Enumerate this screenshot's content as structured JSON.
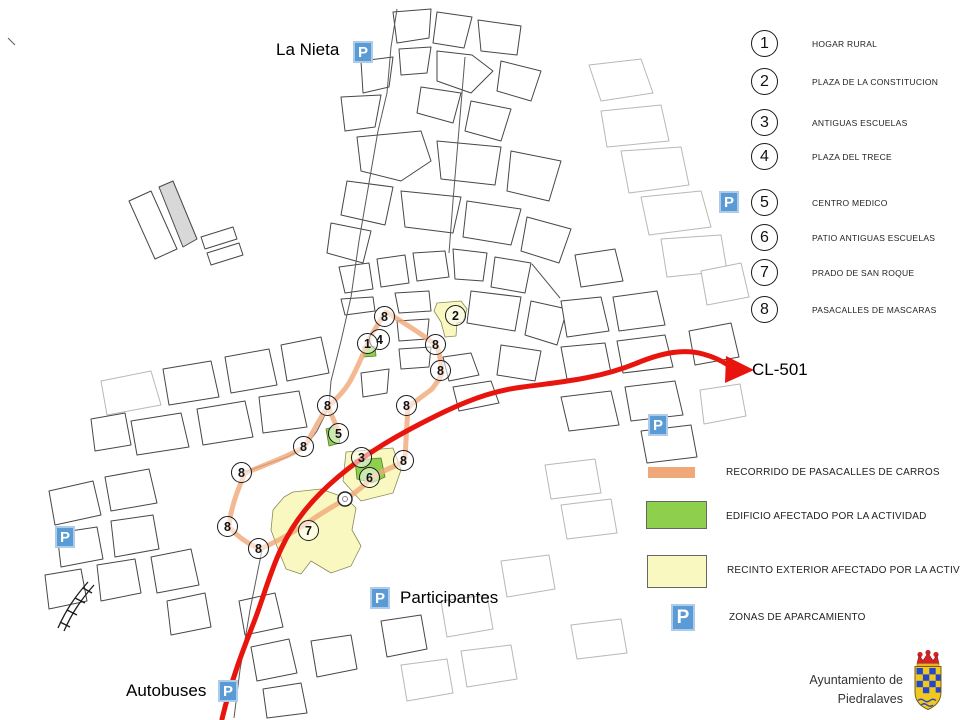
{
  "map_labels": {
    "la_nieta": "La Nieta",
    "cl_501": "CL-501",
    "participantes": "Participantes",
    "autobuses": "Autobuses"
  },
  "parking_symbol": "P",
  "numbered_legend": {
    "items": [
      {
        "number": "1",
        "label": "HOGAR RURAL"
      },
      {
        "number": "2",
        "label": "PLAZA DE LA CONSTITUCION"
      },
      {
        "number": "3",
        "label": "ANTIGUAS ESCUELAS"
      },
      {
        "number": "4",
        "label": "PLAZA DEL TRECE"
      },
      {
        "number": "5",
        "label": "CENTRO MEDICO"
      },
      {
        "number": "6",
        "label": "PATIO ANTIGUAS ESCUELAS"
      },
      {
        "number": "7",
        "label": "PRADO DE SAN ROQUE"
      },
      {
        "number": "8",
        "label": "PASACALLES DE MASCARAS"
      }
    ]
  },
  "zone_legend": {
    "items": [
      {
        "type": "route",
        "color": "#f2a46c",
        "label": "RECORRIDO DE PASACALLES DE CARROS"
      },
      {
        "type": "building",
        "color": "#8ed04e",
        "label": "EDIFICIO AFECTADO POR LA ACTIVIDAD"
      },
      {
        "type": "area",
        "color": "#fafac0",
        "label": "RECINTO EXTERIOR AFECTADO POR LA ACTIVIDAD"
      },
      {
        "type": "parking",
        "color": "#5b9bd5",
        "label": "ZONAS DE APARCAMIENTO"
      }
    ]
  },
  "colors": {
    "road": "#e8150e",
    "route": "#f0a878",
    "building": "#8ed04e",
    "area": "#f8f8c0",
    "parking_blue": "#5b9bd5"
  },
  "map_markers": [
    {
      "n": "8",
      "x": 385,
      "y": 317
    },
    {
      "n": "2",
      "x": 456,
      "y": 316
    },
    {
      "n": "4",
      "x": 380,
      "y": 340
    },
    {
      "n": "1",
      "x": 368,
      "y": 344
    },
    {
      "n": "8",
      "x": 436,
      "y": 345
    },
    {
      "n": "8",
      "x": 441,
      "y": 371
    },
    {
      "n": "8",
      "x": 328,
      "y": 406
    },
    {
      "n": "8",
      "x": 407,
      "y": 406
    },
    {
      "n": "5",
      "x": 339,
      "y": 434
    },
    {
      "n": "8",
      "x": 304,
      "y": 447
    },
    {
      "n": "3",
      "x": 362,
      "y": 458
    },
    {
      "n": "8",
      "x": 404,
      "y": 461
    },
    {
      "n": "6",
      "x": 370,
      "y": 478
    },
    {
      "n": "8",
      "x": 242,
      "y": 473
    },
    {
      "n": "8",
      "x": 228,
      "y": 527
    },
    {
      "n": "7",
      "x": 309,
      "y": 531
    },
    {
      "n": "8",
      "x": 259,
      "y": 549
    }
  ],
  "parking_markers": [
    {
      "x": 363,
      "y": 52
    },
    {
      "x": 658,
      "y": 425
    },
    {
      "x": 65,
      "y": 537
    },
    {
      "x": 380,
      "y": 598
    },
    {
      "x": 228,
      "y": 691
    }
  ],
  "footer": {
    "line1": "Ayuntamiento de",
    "line2": "Piedralaves"
  }
}
